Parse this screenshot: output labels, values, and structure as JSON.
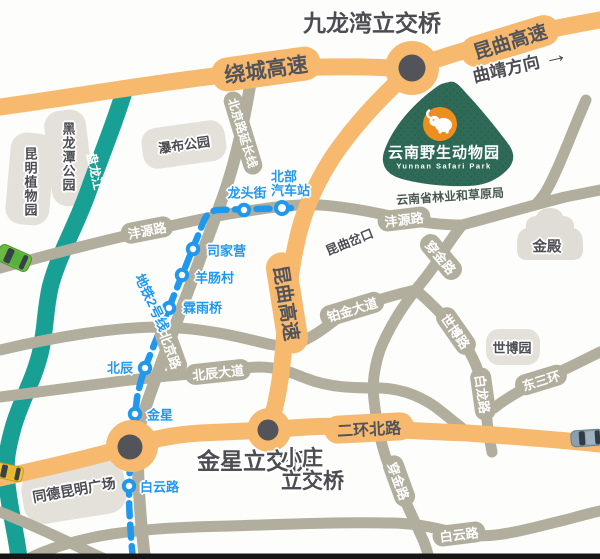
{
  "colors": {
    "expressway_orange": "#F6B96E",
    "road_gray": "#B2AE9D",
    "river_teal": "#18A094",
    "metro_blue": "#1F98EE",
    "safari_green": "#2E6A56",
    "logo_orange": "#EF8E1C",
    "label_dark": "#4C4C52",
    "park_fill": "#E4E1DB"
  },
  "interchanges": {
    "jiulongwan": "九龙湾立交桥",
    "jinxing": "金星立交桥",
    "xiaozhuang_line1": "小庄",
    "xiaozhuang_line2": "立交桥"
  },
  "direction": {
    "qujing": "曲靖方向",
    "arrow": "→"
  },
  "expressways": {
    "raocheng": "绕城高速",
    "kunqu_ne": "昆曲高速",
    "kunqu_s": "昆曲高速",
    "erhuan_north": "二环北路"
  },
  "roads": {
    "fengyuan_w": "沣源路",
    "fengyuan_e": "沣源路",
    "beijing_ext": "北京路延长线",
    "beijing": "北京路",
    "beichen_ave": "北辰大道",
    "bojin_ave": "铂金大道",
    "chuanjin_n": "穿金路",
    "chuanjin_s": "穿金路",
    "shibo": "世博路",
    "bailong": "白龙路",
    "dongsanhuan": "东三环",
    "baiyun": "白云路",
    "kunqu_fork": "昆曲岔口"
  },
  "metro": {
    "line_label": "地铁2号线",
    "north_bus_line1": "北部",
    "north_bus_line2": "汽车站",
    "stations": {
      "longtoujie": "龙头街",
      "sijiaying": "司家营",
      "yangchangcun": "羊肠村",
      "linyuqiao": "霖雨桥",
      "beichen": "北辰",
      "jinxing": "金星",
      "baiyunlu": "白云路"
    }
  },
  "places": {
    "heilongtan_park": "黑龙潭公园",
    "botanical_garden": "昆明植物园",
    "waterfall_park": "瀑布公园",
    "panlong_river": "盘龙江",
    "golden_temple": "金殿",
    "expo_garden": "世博园",
    "tongde_plaza": "同德昆明广场",
    "forestry_bureau": "云南省林业和草原局"
  },
  "safari_park": {
    "name_cn": "云南野生动物园",
    "name_en": "Yunnan Safari Park"
  }
}
